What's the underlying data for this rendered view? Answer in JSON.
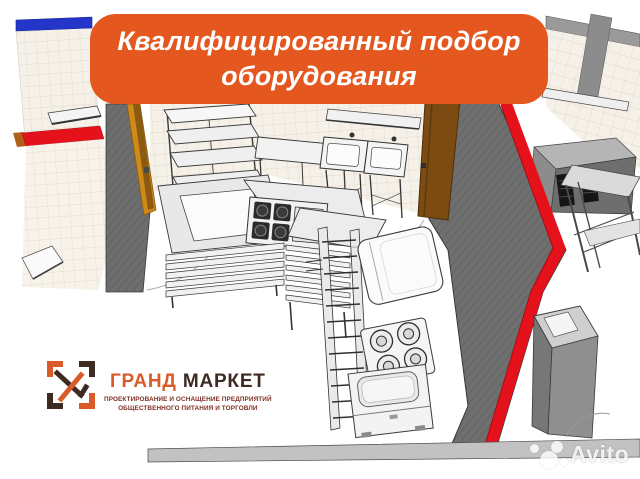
{
  "banner": {
    "line1": "Квалифицированный подбор",
    "line2": "оборудования",
    "bg_color": "#E4571F"
  },
  "logo": {
    "brand_first": "ГРАНД",
    "brand_second": "МАРКЕТ",
    "tagline_line1": "ПРОЕКТИРОВАНИЕ И ОСНАЩЕНИЕ ПРЕДПРИЯТИЙ",
    "tagline_line2": "ОБЩЕСТВЕННОГО ПИТАНИЯ И ТОРГОВЛИ",
    "accent_color": "#D95B2A",
    "dark_color": "#3C2A23",
    "tagline_color": "#7E2F24"
  },
  "watermark": {
    "text": "Avito"
  },
  "scene": {
    "kind": "3d-axonometric-render-of-commercial-kitchen",
    "colors": {
      "tile_cream": "#F6F1E8",
      "tile_grid": "#DAD3C3",
      "accent_blue_stripe": "#2336C9",
      "wall_top_trim_red": "#E6121B",
      "big_wall_gray": "#6F6F6F",
      "door_brown": "#7C4B12",
      "door_amber": "#D08A17",
      "equipment_white": "#F4F4F4",
      "floor_band_gray": "#C2C2C2",
      "vent_black": "#151515"
    }
  }
}
